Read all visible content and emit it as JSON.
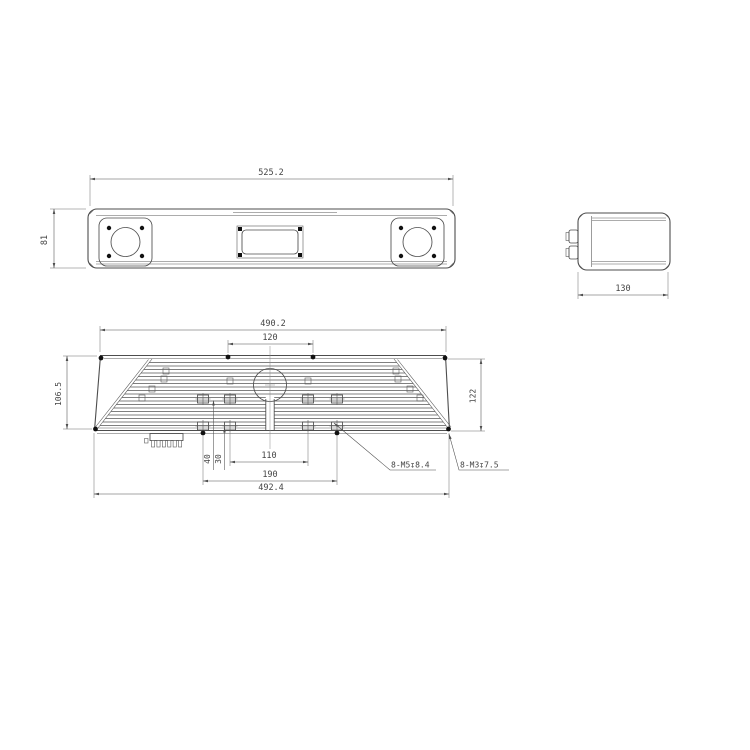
{
  "front": {
    "width": "525.2",
    "height": "81"
  },
  "side": {
    "depth": "130"
  },
  "bottom": {
    "top_width": "490.2",
    "hole_span_top": "120",
    "left_height": "106.5",
    "right_height": "122",
    "hole_span_inner": "110",
    "hole_span_outer": "190",
    "bottom_width": "492.4",
    "offset_a": "40",
    "offset_b": "30",
    "thread_m5": "8-M5↧8.4",
    "thread_m3": "8-M3↧7.5"
  },
  "colors": {
    "line": "#4d4d4d",
    "text": "#444444",
    "background": "#ffffff"
  }
}
